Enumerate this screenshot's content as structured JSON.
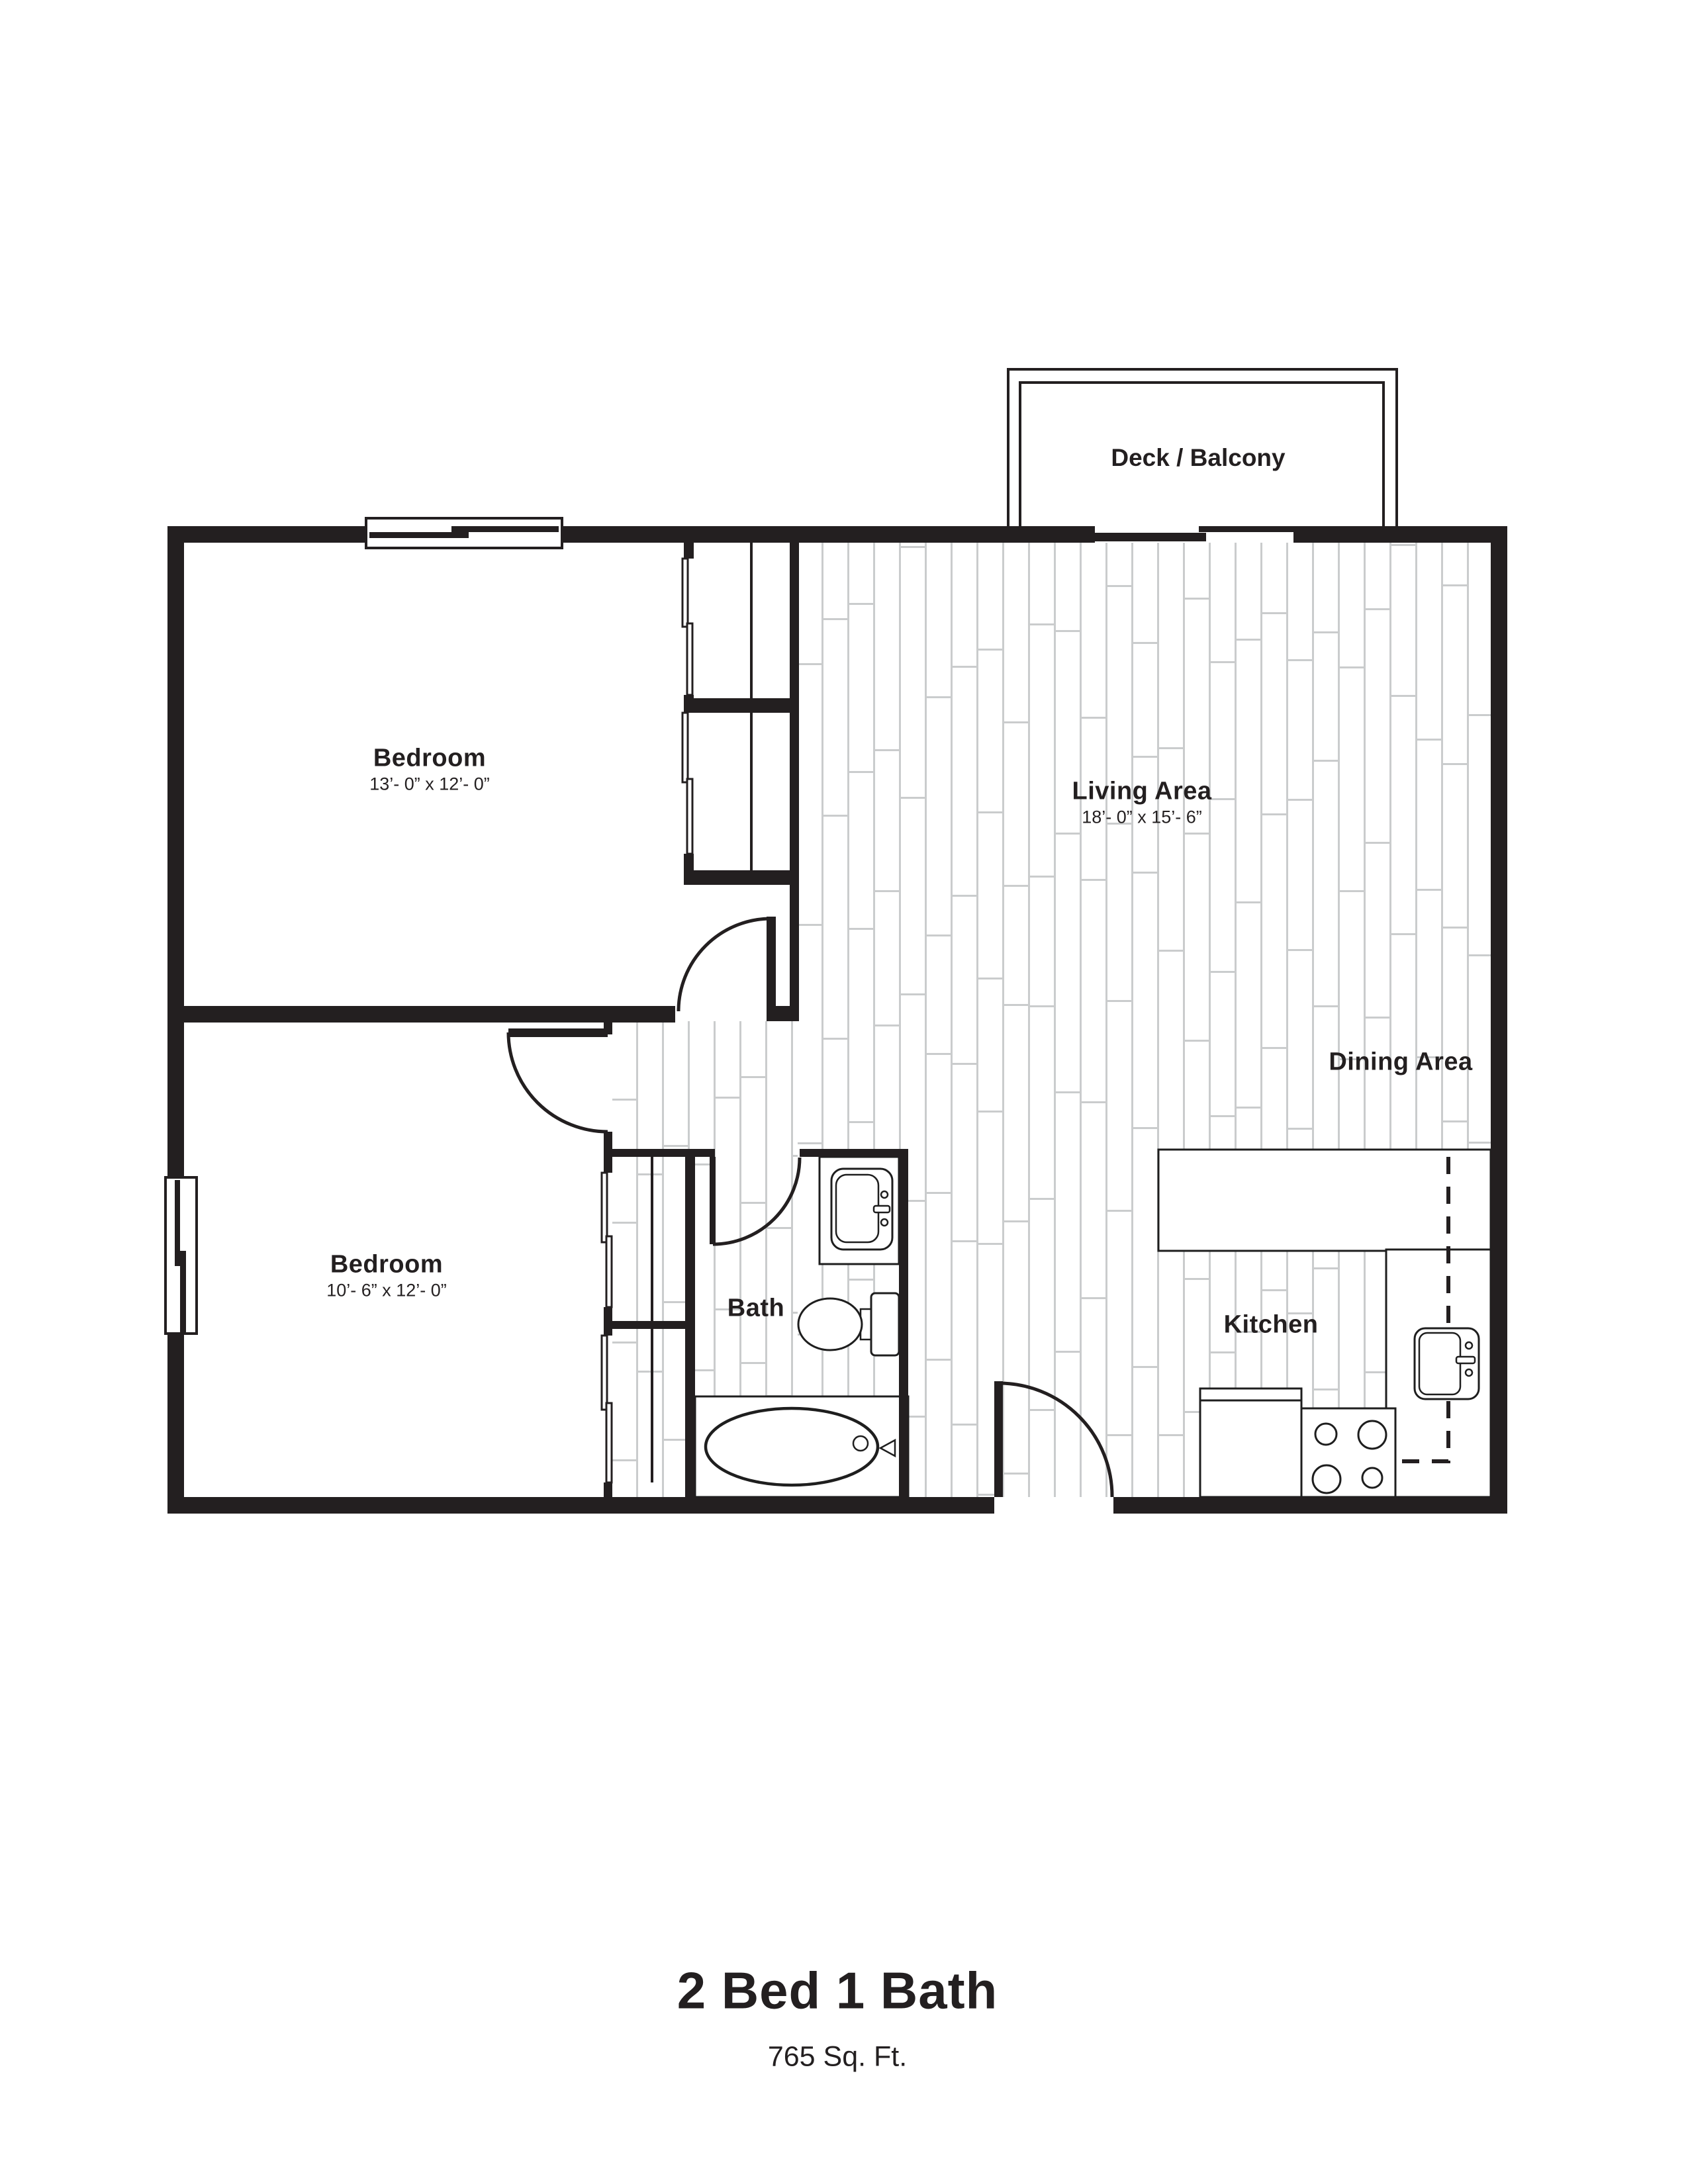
{
  "floorplan": {
    "title": "2 Bed 1 Bath",
    "subtitle": "765 Sq. Ft.",
    "rooms": {
      "deck": {
        "name": "Deck / Balcony"
      },
      "bedroom1": {
        "name": "Bedroom",
        "dims": "13’- 0” x 12’- 0”"
      },
      "bedroom2": {
        "name": "Bedroom",
        "dims": "10’- 6” x 12’- 0”"
      },
      "living": {
        "name": "Living Area",
        "dims": "18’- 0” x 15’- 6”"
      },
      "dining": {
        "name": "Dining Area"
      },
      "bath": {
        "name": "Bath"
      },
      "kitchen": {
        "name": "Kitchen"
      }
    },
    "colors": {
      "wall": "#231f20",
      "fixture_outline": "#1e1e1e",
      "plank_line": "#cacccd",
      "text": "#231f20"
    }
  }
}
